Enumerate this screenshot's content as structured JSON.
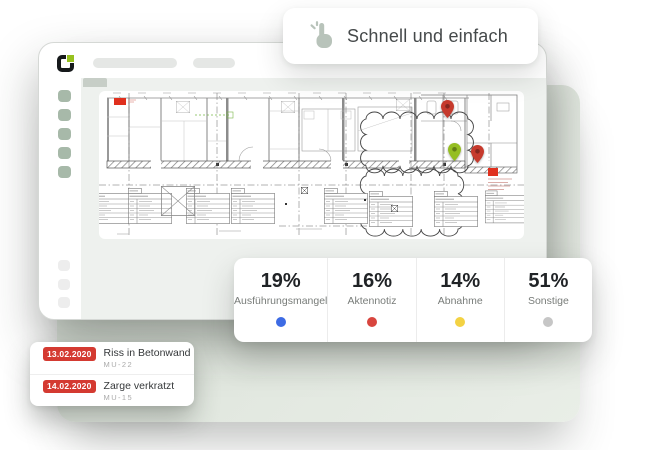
{
  "banner": {
    "text": "Schnell und einfach",
    "icon": "tap-click-icon"
  },
  "browser": {
    "logo_icon": "planradar-logo",
    "logo_accent_color": "#97c11f",
    "sidebar_active_color": "#a7b9a9"
  },
  "plan": {
    "pin_icon": "map-pin-icon",
    "pins": [
      {
        "type": "red-pin",
        "color": "#c63a2d",
        "x": 342,
        "y": 9
      },
      {
        "type": "green-pin",
        "color": "#95be22",
        "x": 349,
        "y": 52
      },
      {
        "type": "red-pin",
        "color": "#c63a2d",
        "x": 372,
        "y": 54
      }
    ],
    "flag_color": "#e0301e"
  },
  "stats": {
    "items": [
      {
        "value": "19%",
        "label": "Ausführungsmangel",
        "color": "#3d6be4"
      },
      {
        "value": "16%",
        "label": "Aktennotiz",
        "color": "#d8453e"
      },
      {
        "value": "14%",
        "label": "Abnahme",
        "color": "#f3d243"
      },
      {
        "value": "51%",
        "label": "Sonstige",
        "color": "#c6c6c6"
      }
    ]
  },
  "tickets": {
    "badge_color": "#d43a31",
    "items": [
      {
        "date": "13.02.2020",
        "title": "Riss in Betonwand",
        "code": "MU-22"
      },
      {
        "date": "14.02.2020",
        "title": "Zarge verkratzt",
        "code": "MU-15"
      }
    ]
  }
}
